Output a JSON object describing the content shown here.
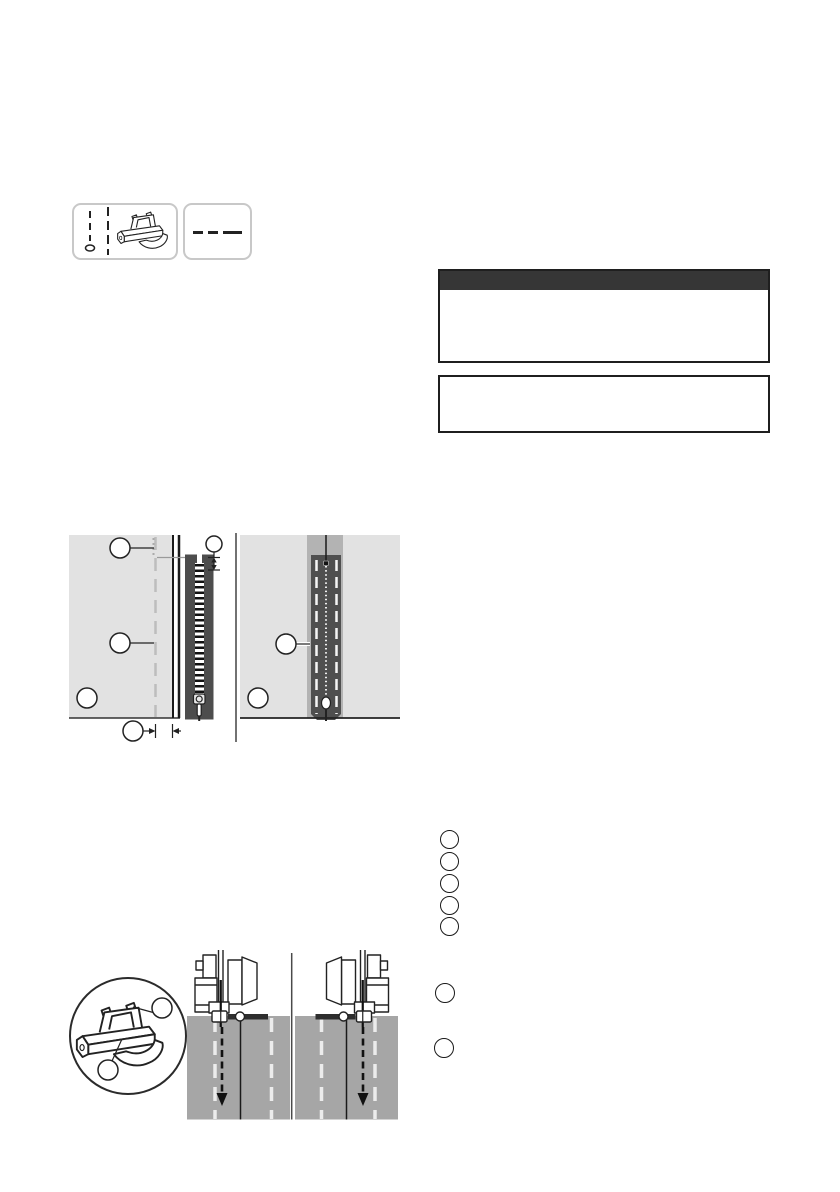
{
  "page": {
    "width": 840,
    "height": 1192,
    "background": "#ffffff"
  },
  "colors": {
    "caution_header_bg": "#363636",
    "box_border": "#1f1f1f",
    "rounded_box_border": "#c8c8c8",
    "fabric_light": "#e2e2e2",
    "fabric_medium": "#a6a6a6",
    "placket_strip": "#b3b3b3",
    "placket_dark": "#4f4f4f",
    "zipper_tape": "#4d4d4d",
    "ink": "#1a1a1a",
    "dash_gray": "#bdbdbd"
  },
  "stitch_header": {
    "icons": [
      "needle-position-marks",
      "zipper-foot-icon",
      "stitch-pattern-dashes"
    ],
    "stitch_pattern_dash_count": 3
  },
  "caution": {
    "header_label": "",
    "body_text": "",
    "note_text": ""
  },
  "figure_basting": {
    "panels": 2,
    "callout_count_left_panel": 5,
    "callout_count_right_panel": 2,
    "callout_labels": [
      "",
      "",
      "",
      "",
      "",
      "",
      ""
    ]
  },
  "legend": {
    "circle_count": 5
  },
  "steps": {
    "circle_count": 2
  },
  "figure_sewing": {
    "panels": 2,
    "detail_callout_count": 2,
    "detail_callout_labels": [
      "",
      ""
    ]
  }
}
